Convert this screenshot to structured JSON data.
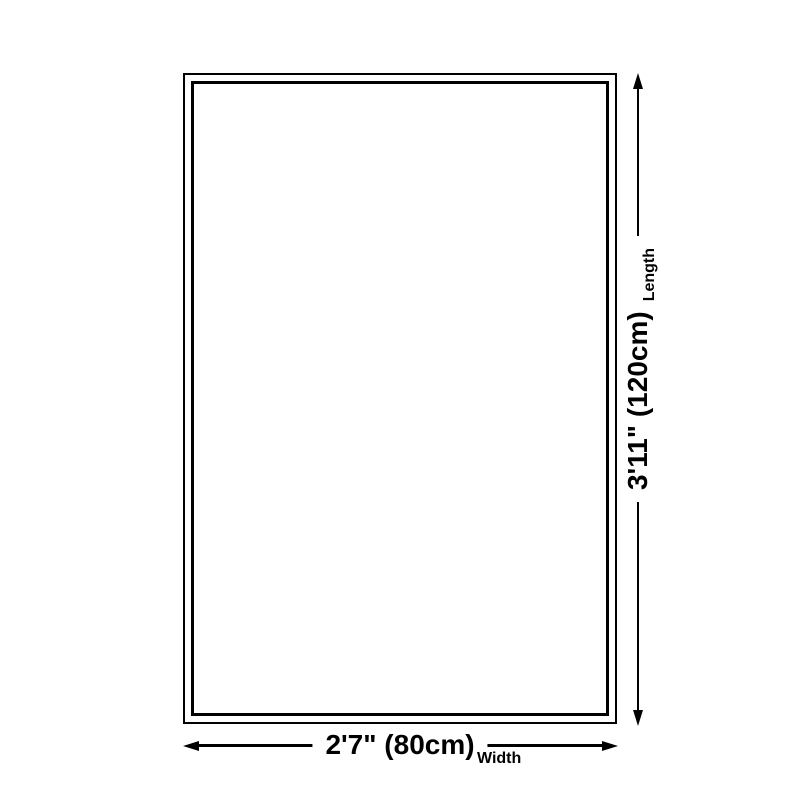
{
  "page": {
    "background_color": "#ffffff",
    "line_color": "#000000"
  },
  "diagram": {
    "type": "product-size-diagram",
    "shape": "rectangle",
    "length": {
      "value": "3'11\" (120cm)",
      "label": "Length"
    },
    "width": {
      "value": "2'7\" (80cm)",
      "label": "Width"
    }
  }
}
